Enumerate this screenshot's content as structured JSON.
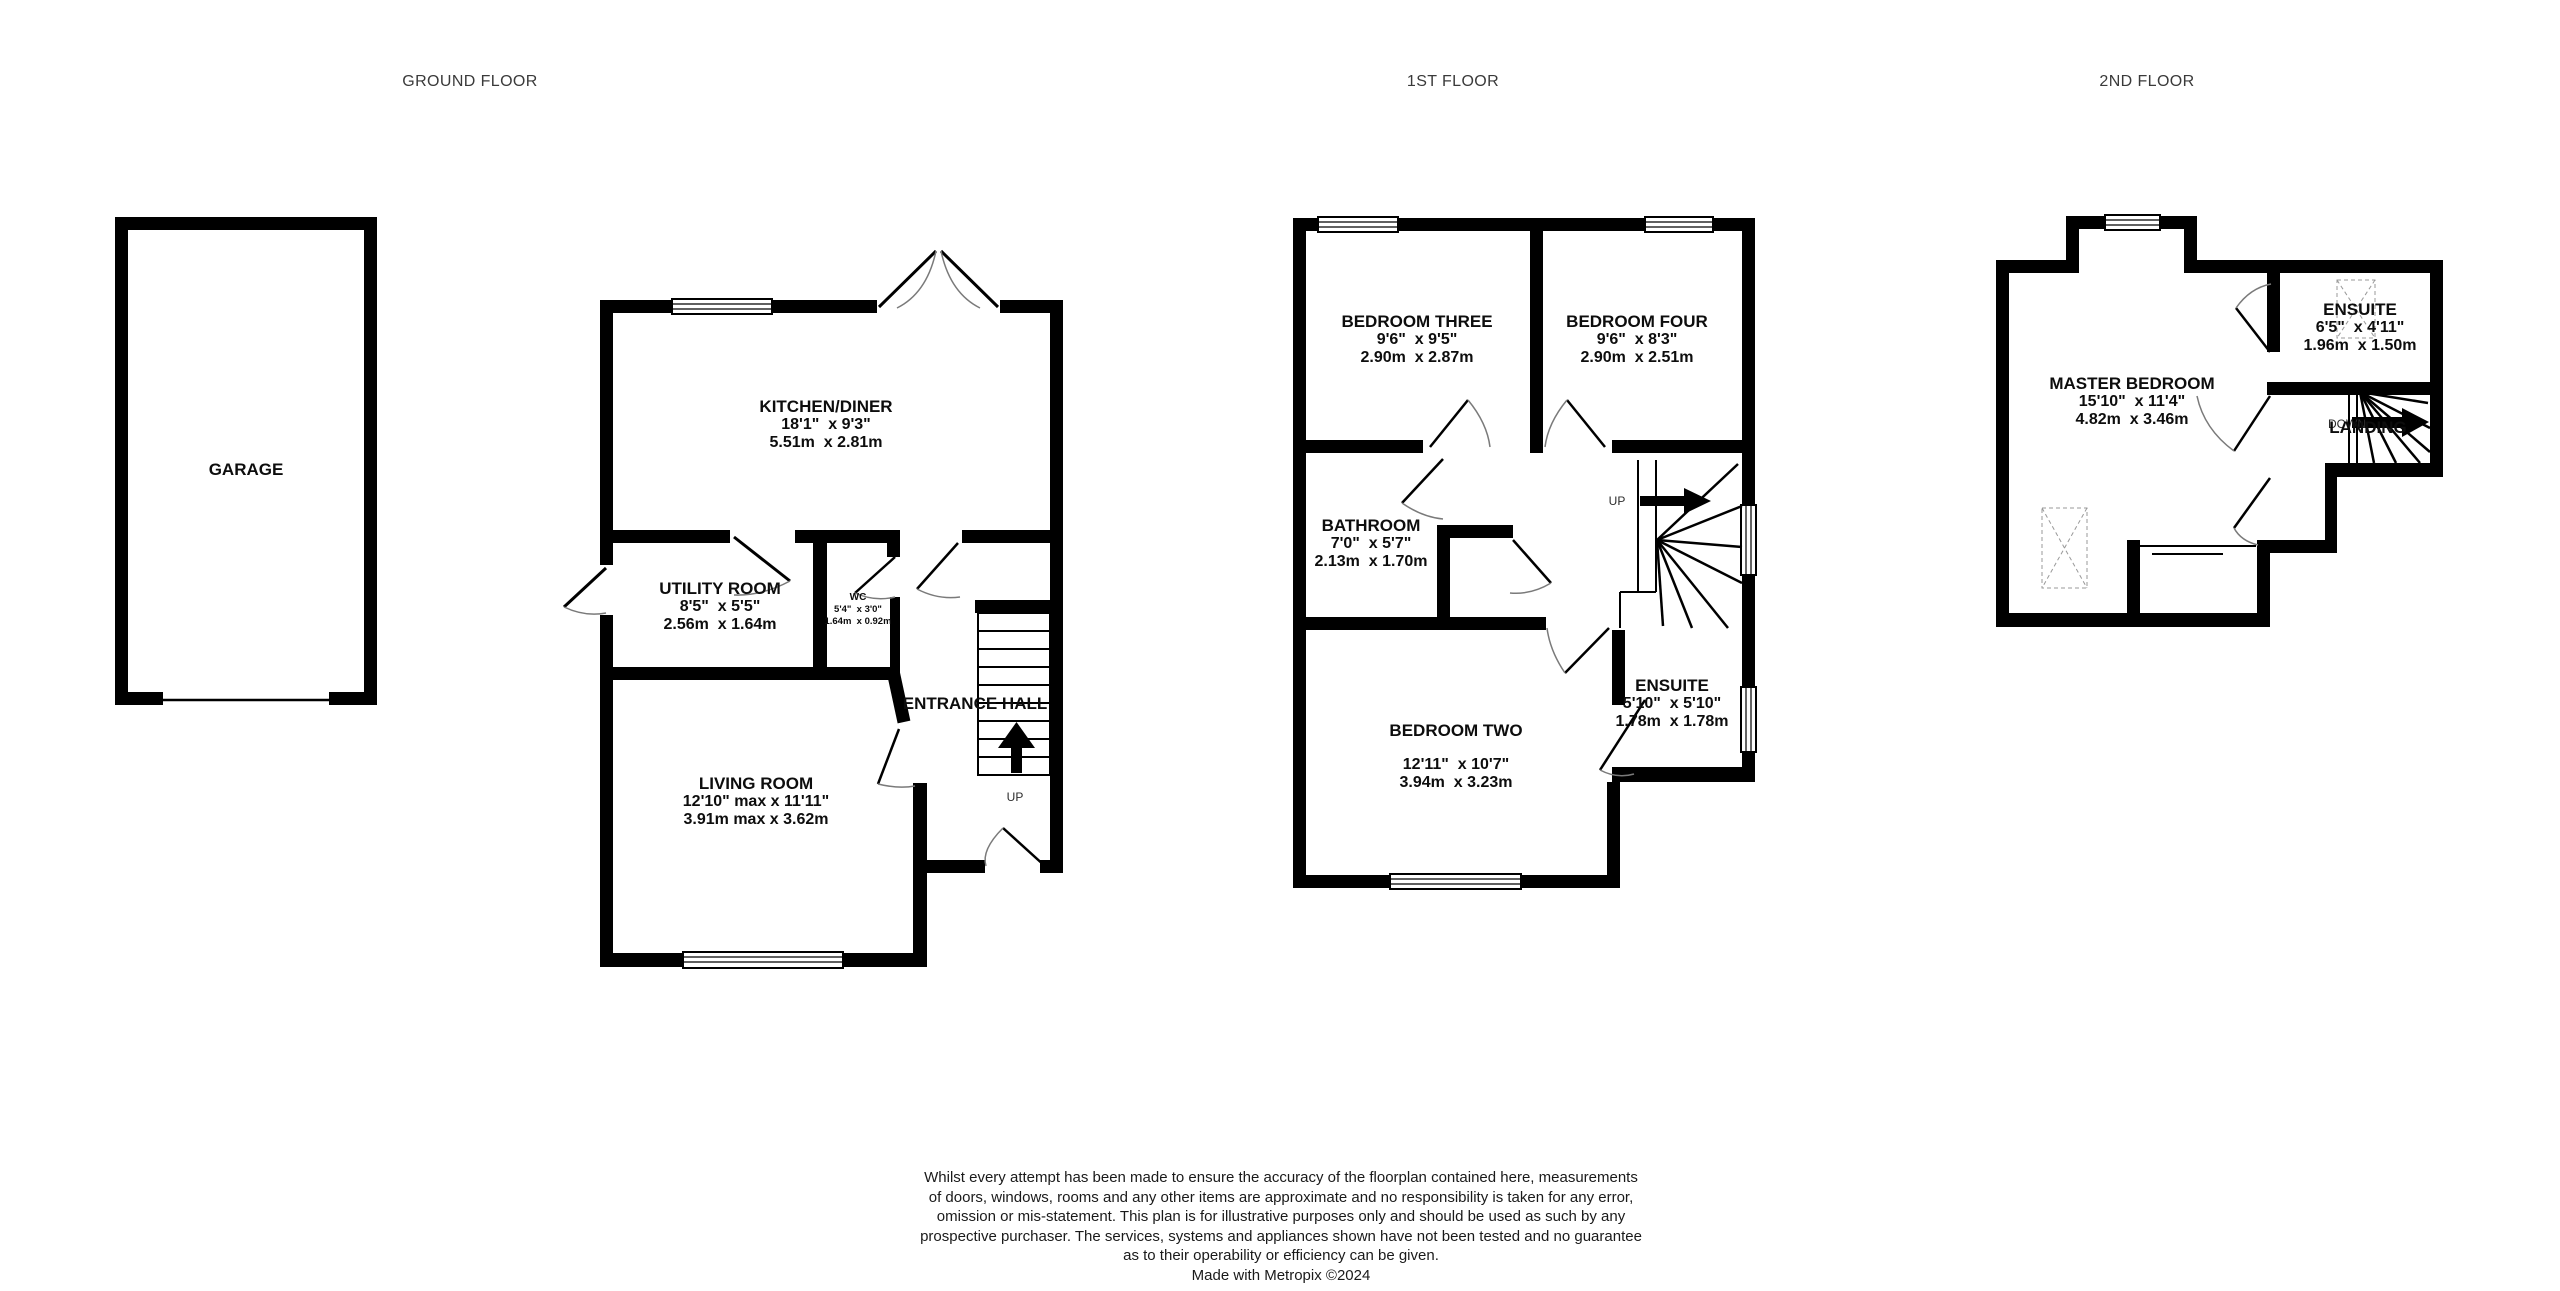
{
  "colors": {
    "wall": "#000000",
    "text": "#0d0d0d",
    "muted": "#3a3a3a",
    "arc": "#7a7a7a"
  },
  "floors": {
    "ground": {
      "title": "GROUND FLOOR",
      "stairs_label": "UP",
      "rooms": {
        "garage": {
          "name": "GARAGE"
        },
        "kitchen_diner": {
          "name": "KITCHEN/DINER",
          "imperial": "18'1\"  x 9'3\"",
          "metric": "5.51m  x 2.81m"
        },
        "utility_room": {
          "name": "UTILITY ROOM",
          "imperial": "8'5\"  x 5'5\"",
          "metric": "2.56m  x 1.64m"
        },
        "wc": {
          "name": "WC",
          "imperial": "5'4\"  x 3'0\"",
          "metric": "1.64m  x 0.92m"
        },
        "entrance_hall": {
          "name": "ENTRANCE HALL"
        },
        "living_room": {
          "name": "LIVING ROOM",
          "imperial": "12'10\" max x 11'11\"",
          "metric": "3.91m max x 3.62m"
        }
      }
    },
    "first": {
      "title": "1ST FLOOR",
      "stairs_label": "UP",
      "rooms": {
        "bedroom_three": {
          "name": "BEDROOM THREE",
          "imperial": "9'6\"  x 9'5\"",
          "metric": "2.90m  x 2.87m"
        },
        "bedroom_four": {
          "name": "BEDROOM FOUR",
          "imperial": "9'6\"  x 8'3\"",
          "metric": "2.90m  x 2.51m"
        },
        "bathroom": {
          "name": "BATHROOM",
          "imperial": "7'0\"  x 5'7\"",
          "metric": "2.13m  x 1.70m"
        },
        "bedroom_two": {
          "name": "BEDROOM TWO",
          "imperial": "12'11\"  x 10'7\"",
          "metric": "3.94m  x 3.23m"
        },
        "ensuite": {
          "name": "ENSUITE",
          "imperial": "5'10\"  x 5'10\"",
          "metric": "1.78m  x 1.78m"
        }
      }
    },
    "second": {
      "title": "2ND FLOOR",
      "stairs_label": "DOWN",
      "rooms": {
        "master_bedroom": {
          "name": "MASTER BEDROOM",
          "imperial": "15'10\"  x 11'4\"",
          "metric": "4.82m  x 3.46m"
        },
        "ensuite": {
          "name": "ENSUITE",
          "imperial": "6'5\"  x 4'11\"",
          "metric": "1.96m  x 1.50m"
        },
        "landing": {
          "name": "LANDING"
        }
      }
    }
  },
  "disclaimer": {
    "lines": [
      "Whilst every attempt has been made to ensure the accuracy of the floorplan contained here, measurements",
      "of doors, windows, rooms and any other items are approximate and no responsibility is taken for any error,",
      "omission or mis-statement. This plan is for illustrative purposes only and should be used as such by any",
      "prospective purchaser. The services, systems and appliances shown have not been tested and no guarantee",
      "as to their operability or efficiency can be given.",
      "Made with Metropix ©2024"
    ]
  }
}
